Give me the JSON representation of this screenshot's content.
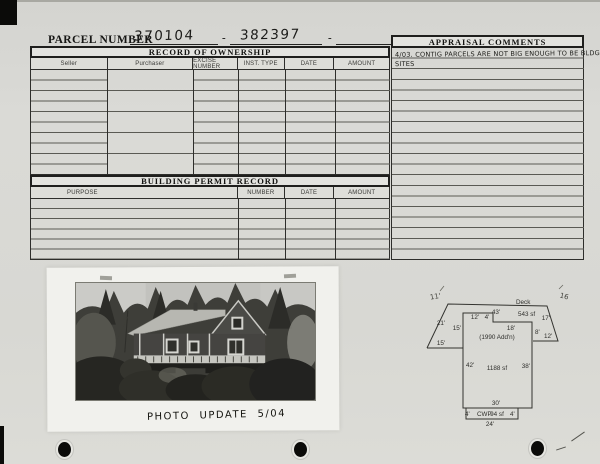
{
  "header": {
    "parcel_label": "PARCEL NUMBER",
    "parcel_1": "370104",
    "dash_1": "-",
    "parcel_2": "382397",
    "dash_2": "-"
  },
  "ownership": {
    "title": "RECORD OF OWNERSHIP",
    "columns": [
      "Seller",
      "Purchaser",
      "EXCISE NUMBER",
      "INST. TYPE",
      "DATE",
      "AMOUNT"
    ]
  },
  "permits": {
    "title": "BUILDING PERMIT RECORD",
    "columns": [
      "PURPOSE",
      "NUMBER",
      "DATE",
      "AMOUNT"
    ]
  },
  "comments": {
    "title": "APPRAISAL COMMENTS",
    "note_line1": "4/03. CONTIG PARCELS ARE NOT BIG ENOUGH TO BE BLDG",
    "note_line2": "SITES"
  },
  "photo": {
    "caption": "PHOTO UPDATE 5/04"
  },
  "sketch": {
    "deck_label": "Deck",
    "deck_area": "543 sf",
    "addn_label": "(1990 Add'n)",
    "main_area": "1188 sf",
    "cwp_label": "CWP",
    "cwp_area": "94 sf",
    "dim_top": "43'",
    "dim_slant_left": "21'",
    "dim_left_mid": "15'",
    "dim_bottom_left": "15'",
    "dim_step_a": "12'",
    "dim_step_b": "4'",
    "dim_top_right": "18'",
    "dim_slant_right": "17'",
    "dim_right_upper": "8'",
    "dim_right_deck": "12'",
    "dim_left": "42'",
    "dim_right": "38'",
    "dim_bottom": "30'",
    "dim_cwp_left": "4'",
    "dim_cwp_right": "4'",
    "dim_cwp_bottom": "24'",
    "hw_note_left": "11'",
    "hw_note_right": "16"
  },
  "colors": {
    "paper": "#d8d8d3",
    "ink": "#1c1c1a",
    "grid_line": "#5a5a54",
    "photo_dark": "#2a2a26"
  }
}
